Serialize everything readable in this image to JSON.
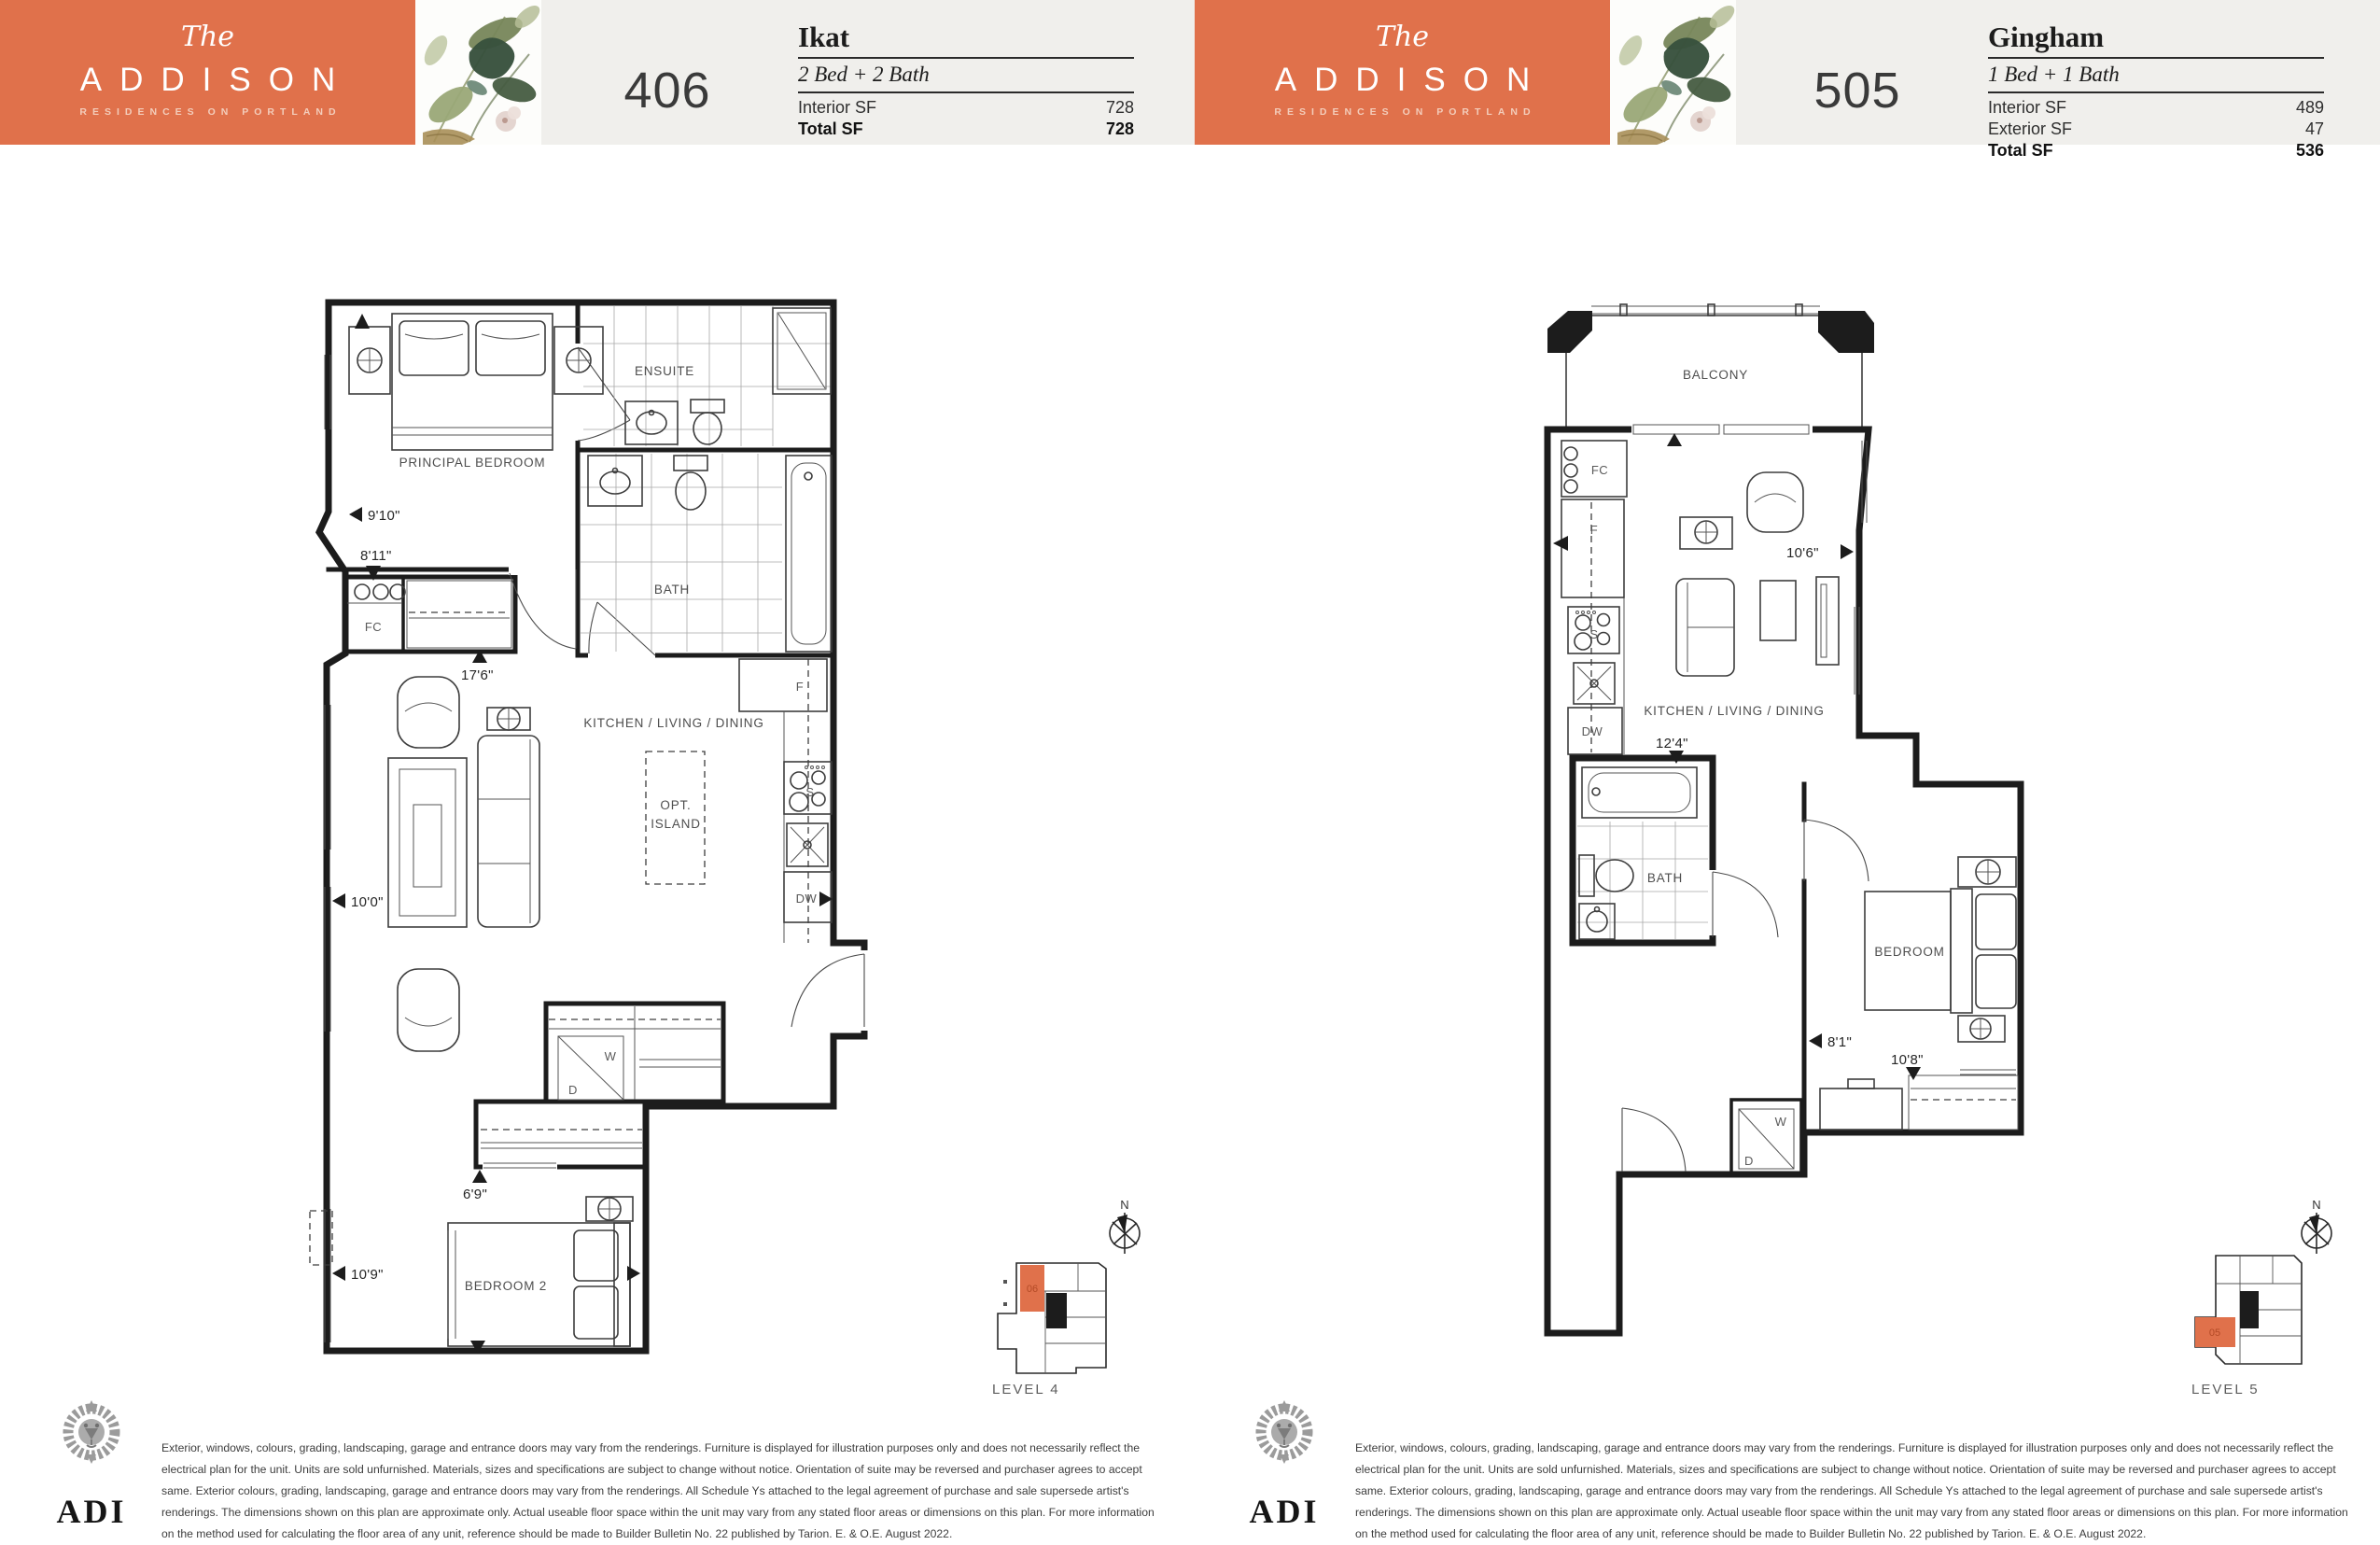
{
  "brand": {
    "the": "The",
    "name": "ADDISON",
    "tagline": "RESIDENCES ON PORTLAND",
    "logo": "ADI",
    "accent": "#e0714b"
  },
  "units": [
    {
      "number": "406",
      "name": "Ikat",
      "type": "2 Bed + 2 Bath",
      "stats": [
        {
          "label": "Interior SF",
          "value": "728"
        },
        {
          "label": "Total SF",
          "value": "728"
        }
      ],
      "level": "LEVEL 4",
      "keyplan_unit": "06",
      "compass_label": "N",
      "labels": {
        "principal_bedroom": "PRINCIPAL BEDROOM",
        "ensuite": "ENSUITE",
        "bath": "BATH",
        "kitchen": "KITCHEN / LIVING / DINING",
        "island_line1": "OPT.",
        "island_line2": "ISLAND",
        "bedroom2": "BEDROOM 2",
        "fc": "FC",
        "f": "F",
        "s": "S",
        "dw": "DW",
        "w": "W",
        "d": "D"
      },
      "dims": {
        "d1": "9'10\"",
        "d2": "8'11\"",
        "d3": "17'6\"",
        "d4": "10'0\"",
        "d5": "6'9\"",
        "d6": "10'9\""
      }
    },
    {
      "number": "505",
      "name": "Gingham",
      "type": "1 Bed + 1 Bath",
      "stats": [
        {
          "label": "Interior SF",
          "value": "489"
        },
        {
          "label": "Exterior SF",
          "value": "47"
        },
        {
          "label": "Total SF",
          "value": "536"
        }
      ],
      "level": "LEVEL 5",
      "keyplan_unit": "05",
      "compass_label": "N",
      "labels": {
        "balcony": "BALCONY",
        "bath": "BATH",
        "kitchen": "KITCHEN / LIVING / DINING",
        "bedroom": "BEDROOM",
        "fc": "FC",
        "f": "F",
        "s": "S",
        "dw": "DW",
        "w": "W",
        "d": "D"
      },
      "dims": {
        "d1": "10'6\"",
        "d2": "12'4\"",
        "d3": "8'1\"",
        "d4": "10'8\""
      }
    }
  ],
  "disclaimer": "Exterior, windows, colours, grading, landscaping, garage and entrance doors may vary from the renderings. Furniture is displayed for illustration purposes only and does not necessarily reflect the electrical plan for the unit. Units are sold unfurnished. Materials, sizes and specifications are subject to change without notice. Orientation of suite may be reversed and purchaser agrees to accept same. Exterior colours, grading, landscaping, garage and entrance doors may vary from the renderings. All Schedule Ys attached to the legal agreement of purchase and sale supersede artist's renderings. The dimensions shown on this plan are approximate only. Actual useable floor space within the unit may vary from any stated floor areas or dimensions on this plan. For more information on the method used for calculating the floor area of any unit, reference should be made to Builder Bulletin No. 22 published by Tarion. E. & O.E. August 2022."
}
